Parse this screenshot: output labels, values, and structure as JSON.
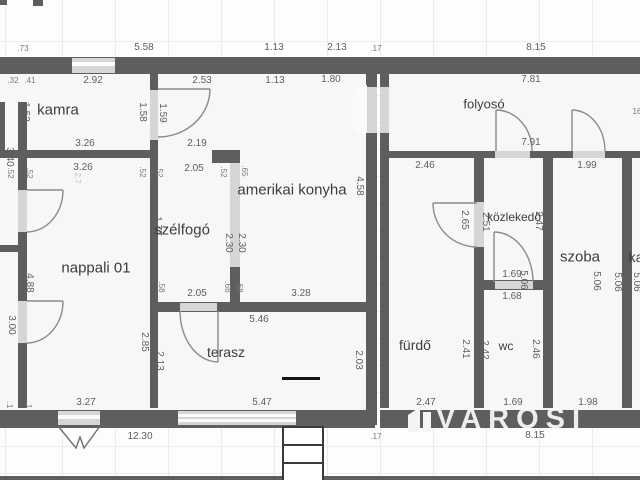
{
  "watermark": {
    "text": "VAROSI"
  },
  "rooms": {
    "kamra": "kamra",
    "szelfogo": "szélfogó",
    "nappali": "nappali 01",
    "konyha": "amerikai konyha",
    "terasz": "terasz",
    "folyoso": "folyosó",
    "furdo": "fürdő",
    "kozlekedo": "közlekedő",
    "wc": "wc",
    "szoba": "szoba",
    "kazan_clipped": "ka"
  },
  "dims": {
    "top_073": ".73",
    "top_558": "5.58",
    "top_113": "1.13",
    "top_213": "2.13",
    "top_017": ".17",
    "top_815": "8.15",
    "row2_292": "2.92",
    "row2_253": "2.53",
    "row2_113": "1.13",
    "row2_180": "1.80",
    "row2_781": "7.81",
    "row2_032": ".32",
    "row2_041": ".41",
    "kamra_152": "1.52",
    "kamra_158": "1.58",
    "kamra_159": "1.59",
    "kamra_326": "3.26",
    "kamra_219": "2.19",
    "folyoso_791": "7.91",
    "folyoso_16": "16",
    "furdo_246": "2.46",
    "szoba_199": "1.99",
    "r170_52a": ".52",
    "r170_52b": ".52",
    "r170_52c": ".52",
    "r170_52d": ".52",
    "r170_52e": ".52",
    "r170_65": ".65",
    "r170_205": "2.05",
    "r170_326": "3.26",
    "r170_27": "2.7",
    "konyha_458": "4.58",
    "konyha_230a": "2.30",
    "konyha_230b": "2.30",
    "szelfogo_177": "1.77",
    "szelfogo_58": ".58",
    "szelfogo_205": "2.05",
    "szelfogo_68a": ".68",
    "szelfogo_68b": ".68",
    "konyha_328": "3.28",
    "nappali_488": "4.88",
    "nappali_340": "3.40",
    "nappali_300": "3.00",
    "nappali_285": "2.85",
    "nappali_327": "3.27",
    "terasz_546": "5.46",
    "terasz_213": "2.13",
    "terasz_203": "2.03",
    "terasz_547": "5.47",
    "furdo_265": "2.65",
    "koz_251": "2.51",
    "koz_247": "2.47",
    "furdo_506": "5.06",
    "koz_506": "5.06",
    "szoba_506a": "5.06",
    "szoba_506b": "5.06",
    "kazan_506": "5.06",
    "koz_169": "1.69",
    "wc_168": "1.68",
    "wc_241": "2.41",
    "wc_242": "2.42",
    "wc_246": "2.46",
    "furdo_247": "2.47",
    "wc_169": "1.69",
    "szoba_198": "1.98",
    "bot_1230": "12.30",
    "bot_017": ".17",
    "bot_815": "8.15",
    "bl_1a": ".1",
    "bl_1b": ".1"
  },
  "colors": {
    "wall": "#5e5e5e",
    "opening": "#d6d6d6",
    "step": "#141414"
  }
}
